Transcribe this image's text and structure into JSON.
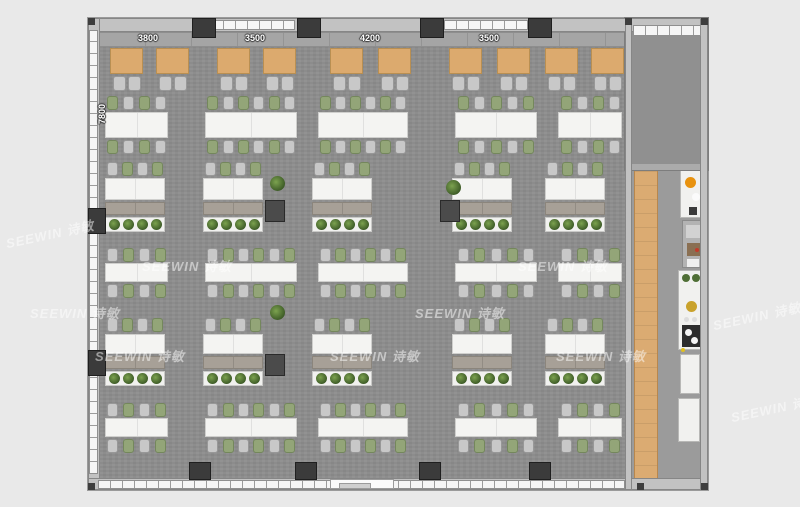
{
  "watermark": {
    "text": "SEEWIN 诗敏"
  },
  "dimensions": {
    "top": [
      "3800",
      "3500",
      "4200",
      "3500"
    ],
    "top_centers_x": [
      148,
      255,
      370,
      489
    ],
    "left": "7800"
  },
  "colors": {
    "page_bg": "#e9e9e9",
    "floor": "#8d8d8d",
    "corridor_floor": "#9b9b9b",
    "wall": "#c2c2c2",
    "window": "#f5f5f5",
    "column_dark": "#3b3b3b",
    "booth_table_wood": "#dcaa6e",
    "walkway_wood": "#dbab72",
    "table_white": "#f4f4f2",
    "chair_gray": "#c8c8c8",
    "chair_green": "#93a578",
    "cabinet": "#a7a097",
    "plant_green": "#3f5d28",
    "appliance_orange": "#e8920f",
    "appliance_gold": "#c9a22c"
  },
  "plan": {
    "banquette": {
      "x": 10,
      "y": 14,
      "w": 527,
      "h": 15
    },
    "booths": {
      "tables_x": [
        22,
        68,
        129,
        175,
        242,
        290,
        361,
        409,
        457,
        503
      ],
      "table_y": 30,
      "table_w": 33,
      "table_h": 26,
      "chair_y": 58,
      "chair_w": 13,
      "chair_h": 15,
      "chair_offsets": [
        3,
        18
      ]
    },
    "team_tables": [
      {
        "x": 17,
        "w": 63
      },
      {
        "x": 117,
        "w": 92
      },
      {
        "x": 230,
        "w": 90
      },
      {
        "x": 367,
        "w": 82
      },
      {
        "x": 470,
        "w": 64
      }
    ],
    "team_rows": [
      {
        "chair_top_y": 78,
        "table_y": 94,
        "table_h": 26,
        "chair_bot_y": 122,
        "start": "green"
      },
      {
        "chair_top_y": 230,
        "table_y": 245,
        "table_h": 19,
        "chair_bot_y": 266,
        "start": "gray"
      },
      {
        "chair_top_y": 385,
        "table_y": 400,
        "table_h": 19,
        "chair_bot_y": 421,
        "start": "gray"
      }
    ],
    "desk_rows": [
      {
        "chair_y": 144,
        "table_y": 160,
        "table_h": 22,
        "cabinet_y": 184,
        "cabinet_h": 13,
        "planter_y": 199,
        "planter_h": 15
      },
      {
        "chair_y": 300,
        "table_y": 316,
        "table_h": 20,
        "cabinet_y": 338,
        "cabinet_h": 13,
        "planter_y": 353,
        "planter_h": 15
      }
    ],
    "desk_groups_x": [
      17,
      115,
      224,
      364,
      457
    ],
    "desk_w": 60,
    "side_tables": [
      {
        "x": 177,
        "y": 182
      },
      {
        "x": 352,
        "y": 182
      },
      {
        "x": 177,
        "y": 336
      }
    ],
    "potted_plants": [
      {
        "x": 182,
        "y": 158
      },
      {
        "x": 358,
        "y": 162
      },
      {
        "x": 182,
        "y": 287
      }
    ],
    "columns_top_x": [
      104,
      209,
      332,
      440
    ],
    "windows_top": [
      {
        "x": 123,
        "w": 84
      },
      {
        "x": 356,
        "w": 84
      }
    ],
    "wall_units_left_y": [
      190,
      332
    ],
    "wall_units_bottom_x": [
      101,
      207,
      331,
      441
    ],
    "door_bottom": {
      "x": 242,
      "w": 64
    },
    "corner_dots": [
      {
        "x": 0,
        "y": 0
      },
      {
        "x": 613,
        "y": 0
      },
      {
        "x": 537,
        "y": 0
      },
      {
        "x": 0,
        "y": 465
      },
      {
        "x": 549,
        "y": 465
      },
      {
        "x": 613,
        "y": 465
      }
    ],
    "fixtures": [
      {
        "cls": "fx-counter",
        "x": 592,
        "y": 152,
        "w": 22,
        "h": 48,
        "items": [
          {
            "x": 4,
            "y": 6,
            "w": 11,
            "h": 11,
            "c": "#e8920f",
            "round": true
          },
          {
            "x": 11,
            "y": 22,
            "w": 8,
            "h": 8,
            "c": "#fbfbfb",
            "round": true
          },
          {
            "x": 8,
            "y": 36,
            "w": 8,
            "h": 8,
            "c": "#3a3a3a",
            "round": false
          }
        ]
      },
      {
        "cls": "fx-equip",
        "x": 594,
        "y": 202,
        "w": 20,
        "h": 48,
        "items": [
          {
            "x": 3,
            "y": 4,
            "w": 14,
            "h": 13,
            "c": "#d2d2d2",
            "round": false
          },
          {
            "x": 4,
            "y": 22,
            "w": 13,
            "h": 13,
            "c": "#8a6f52",
            "round": false
          },
          {
            "x": 12,
            "y": 27,
            "w": 4,
            "h": 4,
            "c": "#c23a2a",
            "round": true
          },
          {
            "x": 4,
            "y": 38,
            "w": 12,
            "h": 8,
            "c": "#efefef",
            "round": false
          }
        ]
      },
      {
        "cls": "fx-counter",
        "x": 590,
        "y": 252,
        "w": 24,
        "h": 80,
        "items": [
          {
            "x": 3,
            "y": 3,
            "w": 8,
            "h": 8,
            "c": "#4f6f35",
            "round": true
          },
          {
            "x": 13,
            "y": 3,
            "w": 8,
            "h": 8,
            "c": "#4f6f35",
            "round": true
          },
          {
            "x": 7,
            "y": 30,
            "w": 11,
            "h": 11,
            "c": "#c9a22c",
            "round": true
          },
          {
            "x": 5,
            "y": 46,
            "w": 5,
            "h": 5,
            "c": "#dddddd",
            "round": true
          },
          {
            "x": 13,
            "y": 46,
            "w": 5,
            "h": 5,
            "c": "#dddddd",
            "round": true
          },
          {
            "x": 3,
            "y": 54,
            "w": 18,
            "h": 22,
            "c": "#2d2d2d",
            "round": false
          },
          {
            "x": 6,
            "y": 58,
            "w": 7,
            "h": 7,
            "c": "#f5f5f5",
            "round": true
          },
          {
            "x": 12,
            "y": 66,
            "w": 7,
            "h": 7,
            "c": "#f5f5f5",
            "round": true
          },
          {
            "x": 2,
            "y": 77,
            "w": 4,
            "h": 4,
            "c": "#e0c020",
            "round": true
          }
        ]
      },
      {
        "cls": "fx-counter",
        "x": 592,
        "y": 336,
        "w": 20,
        "h": 40,
        "items": []
      },
      {
        "cls": "fx-counter",
        "x": 590,
        "y": 380,
        "w": 22,
        "h": 44,
        "items": []
      }
    ]
  },
  "watermarks": [
    {
      "x": 142,
      "y": 256,
      "rot": 0
    },
    {
      "x": 518,
      "y": 256,
      "rot": 0
    },
    {
      "x": 30,
      "y": 303,
      "rot": 0
    },
    {
      "x": 415,
      "y": 303,
      "rot": 0
    },
    {
      "x": 712,
      "y": 306,
      "rot": -12
    },
    {
      "x": 95,
      "y": 346,
      "rot": 0
    },
    {
      "x": 330,
      "y": 346,
      "rot": 0
    },
    {
      "x": 556,
      "y": 346,
      "rot": 0
    },
    {
      "x": 730,
      "y": 398,
      "rot": -12
    },
    {
      "x": 5,
      "y": 224,
      "rot": -12
    }
  ]
}
